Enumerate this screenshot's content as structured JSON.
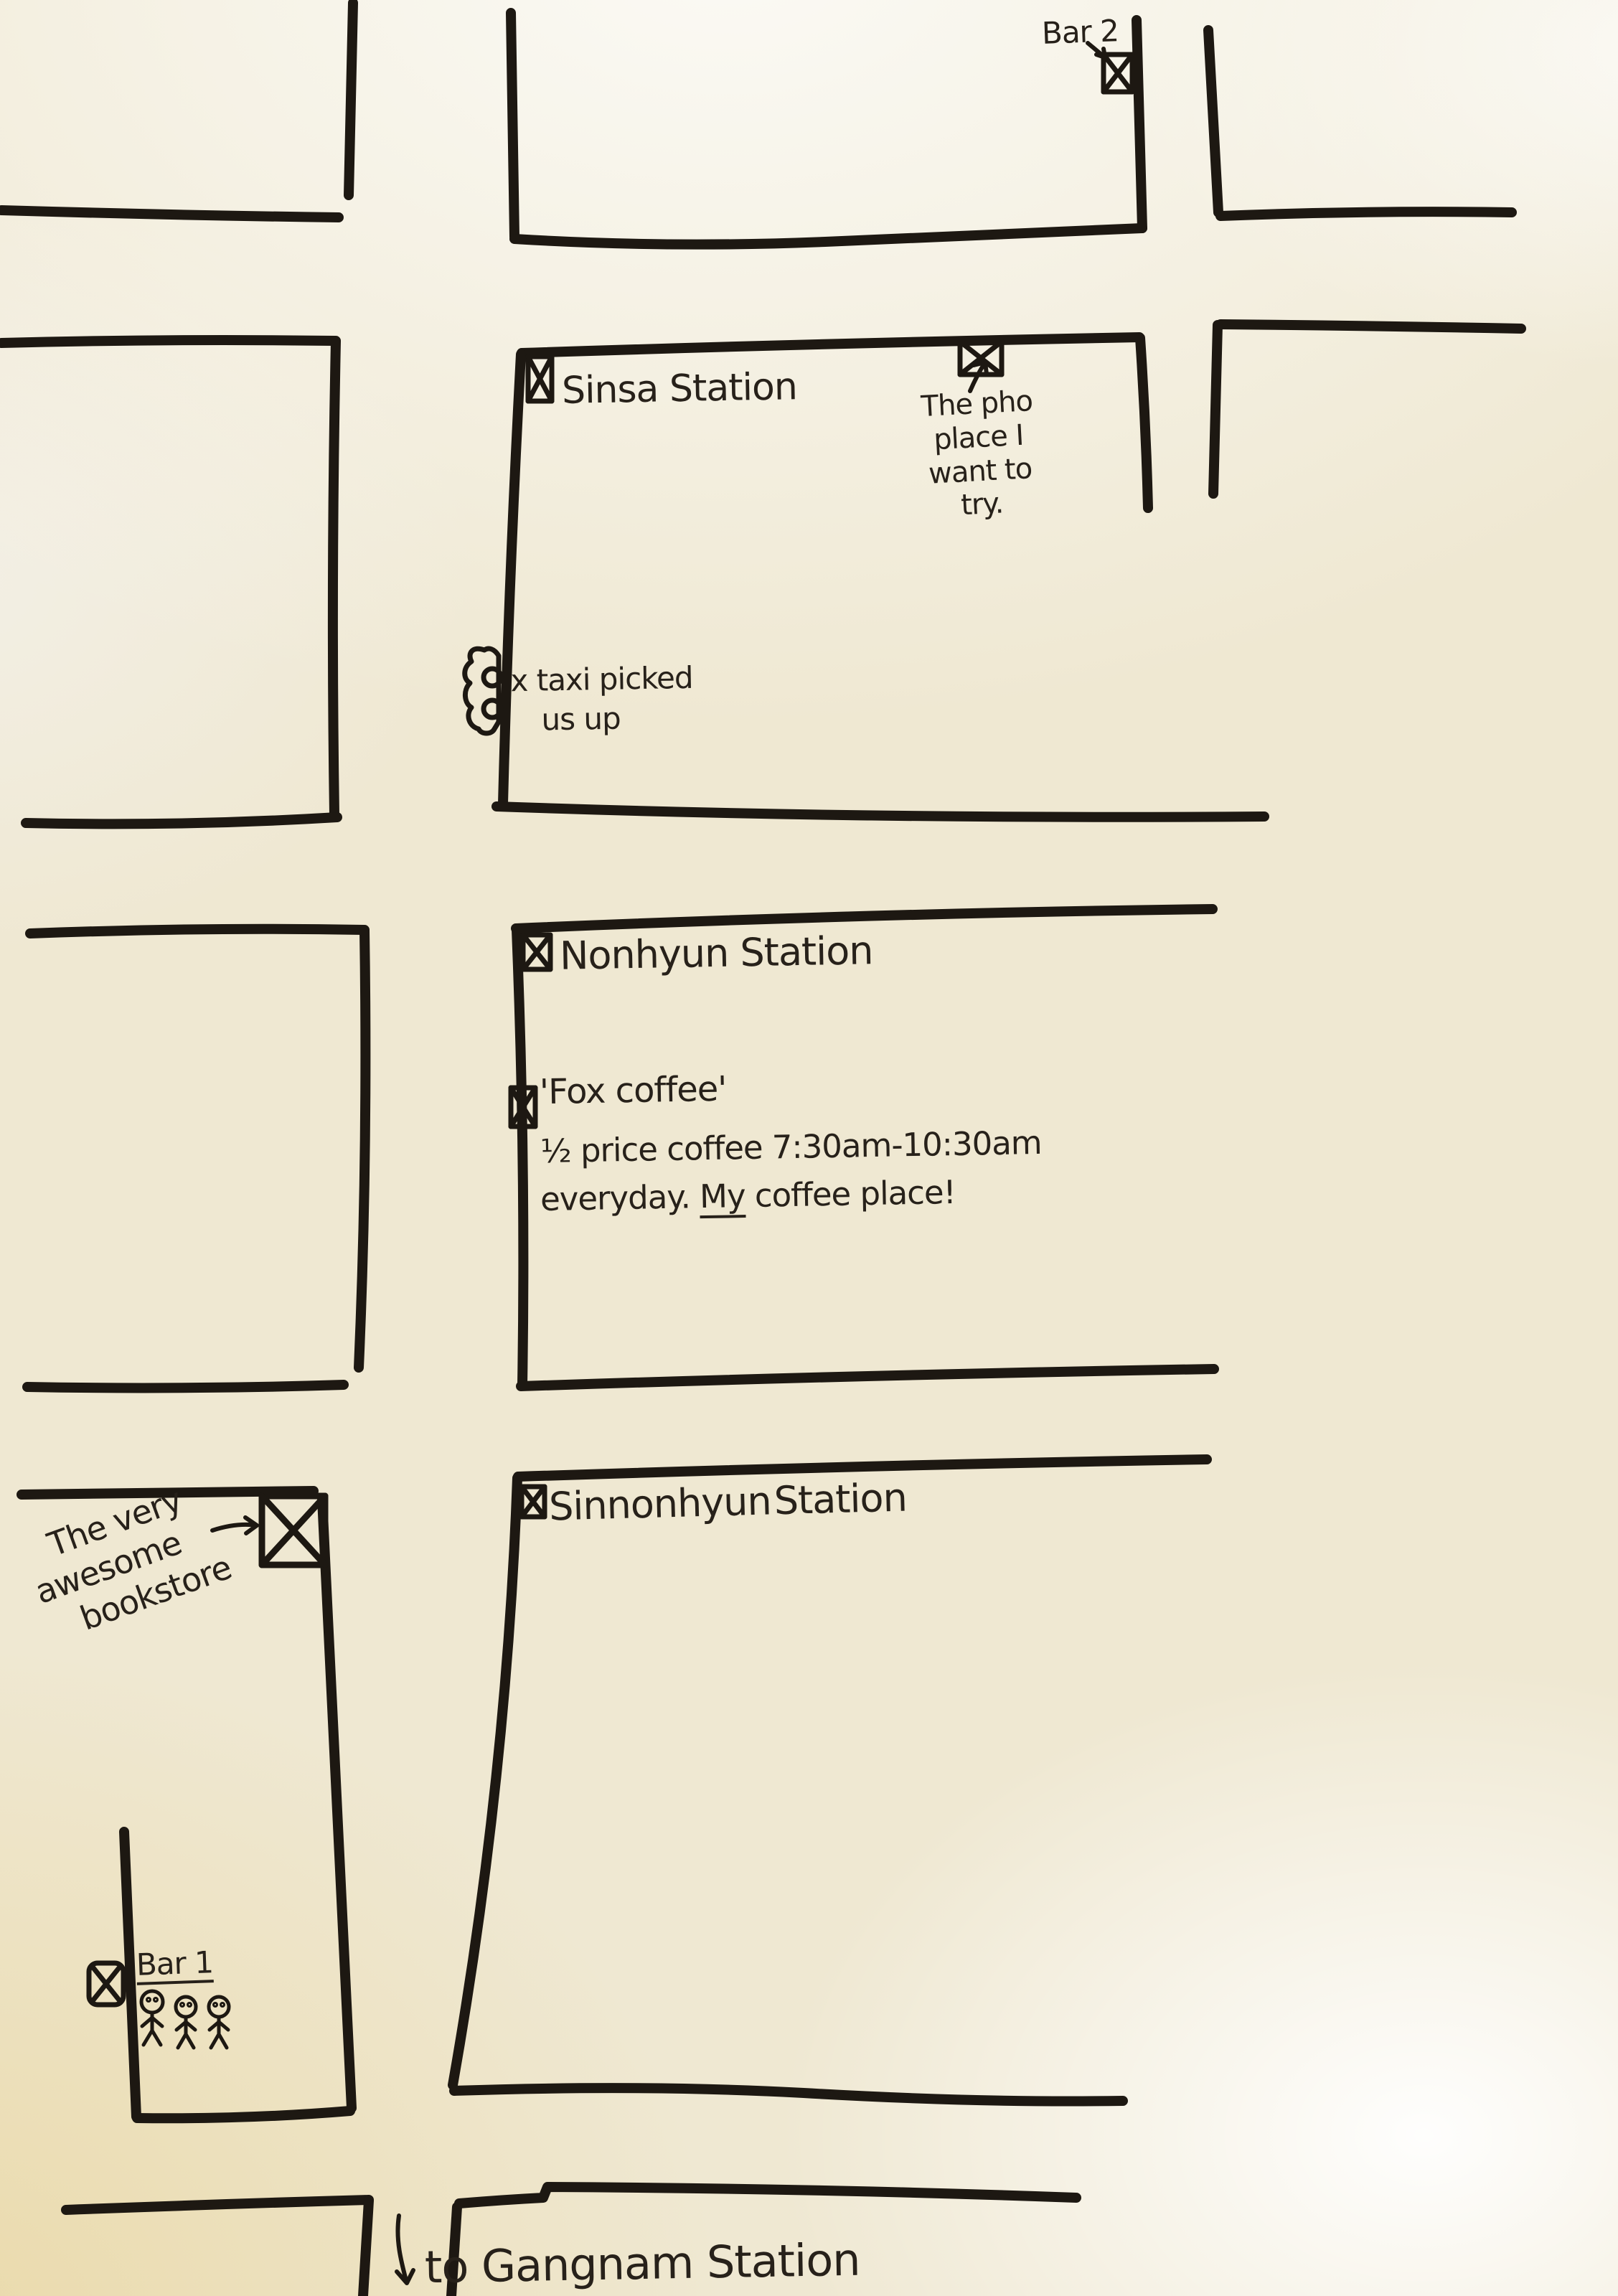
{
  "map_type": "hand-drawn paper street map",
  "colors": {
    "ink": "#1d1812",
    "paper": "#efe8d2"
  },
  "annotations": {
    "bar2": {
      "label": "Bar 2"
    },
    "sinsa": {
      "label": "Sinsa Station"
    },
    "pho": {
      "line1": "The pho",
      "line2": "place I",
      "line3": "want to",
      "line4": "try."
    },
    "taxi": {
      "line1": "x taxi picked",
      "line2": "us up"
    },
    "nonhyun": {
      "label": "Nonhyun Station"
    },
    "fox": {
      "title": "'Fox coffee'",
      "deal": "½ price coffee 7:30am-10:30am",
      "comment_pre": "everyday. ",
      "comment_word": "My",
      "comment_post": " coffee place!"
    },
    "sinnonhyun": {
      "label": "Sinnonhyun Station"
    },
    "bookstore": {
      "line1": "The very",
      "line2": "awesome",
      "line3": "bookstore"
    },
    "bar1": {
      "label": "Bar 1"
    },
    "gangnam": {
      "label": "to Gangnam Station"
    }
  },
  "icons": {
    "station_marker": "x-in-box",
    "bookstore_marker": "large-x-in-box",
    "bar_marker": "x-in-box",
    "taxi_marker": "car-doodle",
    "people": "three-stick-figures",
    "direction_arrows": [
      "up-right-arrow",
      "right-arrow",
      "down-arrow"
    ]
  }
}
